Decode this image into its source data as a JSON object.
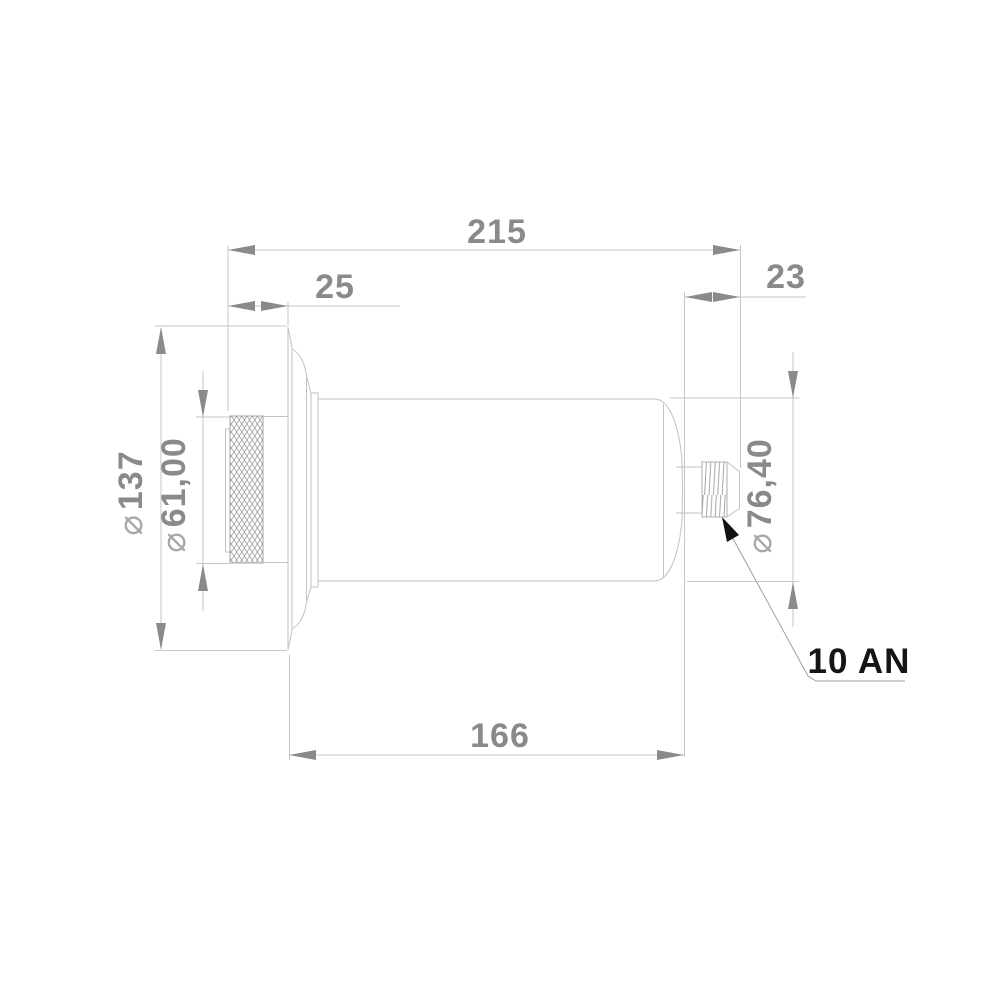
{
  "drawing": {
    "callout": {
      "text": "10 AN"
    },
    "dimensions": {
      "overall_length": {
        "value": "215"
      },
      "cap_protrusion": {
        "value": "25"
      },
      "fitting_protrusion": {
        "value": "23"
      },
      "body_length": {
        "value": "166"
      },
      "flange_diameter": {
        "symbol": "⌀",
        "value": "137"
      },
      "cap_diameter": {
        "symbol": "⌀",
        "value": "61,00"
      },
      "body_diameter": {
        "symbol": "⌀",
        "value": "76,40"
      }
    },
    "colors": {
      "dimension_gray": "#8a8a8a",
      "thin_line_gray": "#c6c6c6",
      "outline_gray": "#bfc3c3",
      "callout_black": "#151515"
    }
  }
}
